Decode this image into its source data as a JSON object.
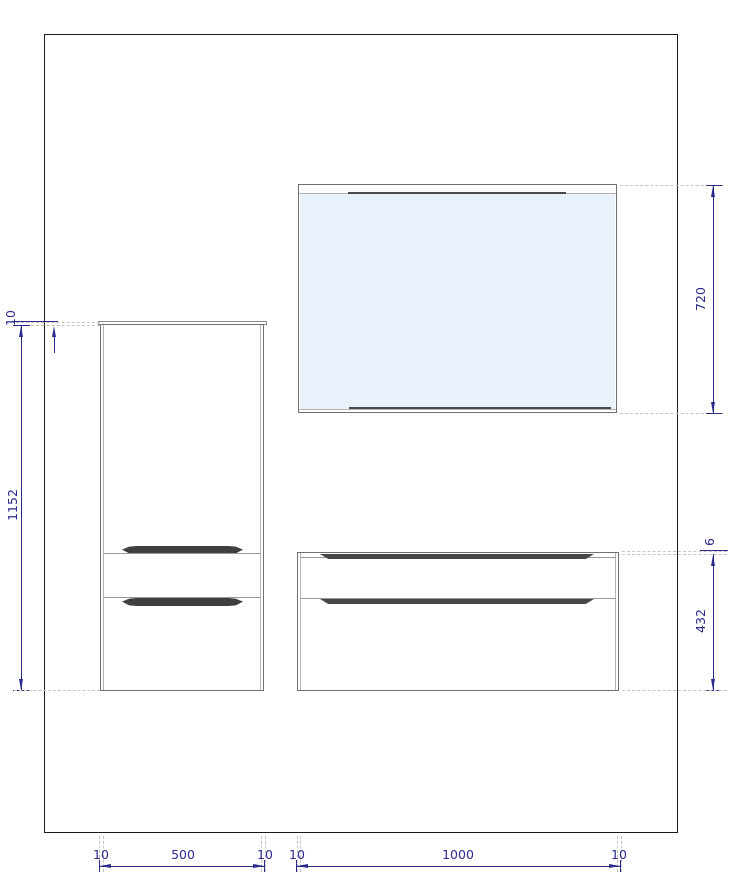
{
  "drawing": {
    "type": "furniture-elevation-technical-drawing",
    "components": [
      "wall",
      "mirror-cabinet",
      "tall-side-cabinet",
      "base-drawer-unit"
    ],
    "dims": {
      "left": {
        "top_offset": "10",
        "height": "1152"
      },
      "right": {
        "mirror_height": "720",
        "gap": "6",
        "unit_height": "432"
      },
      "bottom": {
        "cab_left_offset": "10",
        "cab_width": "500",
        "cab_right_offset": "10",
        "unit_left_offset": "10",
        "unit_width": "1000",
        "unit_right_offset": "10"
      }
    },
    "colors": {
      "dimension": "#2b2b8e",
      "extension_dash": "#c4c4c4",
      "furniture_outline": "#6f6f6f",
      "handle": "#3f3f3f",
      "mirror_glass": "#e9f2fa",
      "wall_outline": "#1a1a1a"
    }
  }
}
